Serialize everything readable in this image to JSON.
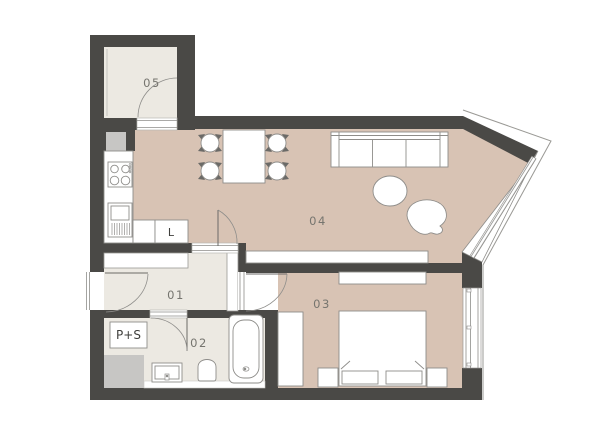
{
  "floorplan": {
    "rooms": {
      "r01": {
        "label": "01",
        "name": "hallway"
      },
      "r02": {
        "label": "02",
        "name": "bathroom"
      },
      "r03": {
        "label": "03",
        "name": "bedroom"
      },
      "r04": {
        "label": "04",
        "name": "living-room-kitchen"
      },
      "r05": {
        "label": "05",
        "name": "storage"
      }
    },
    "fixtures": {
      "fridge": {
        "label": "L"
      },
      "washer_dryer": {
        "label": "P+S"
      }
    },
    "colors": {
      "wall": "#4a4946",
      "floor_main": "#d8c3b4",
      "floor_light": "#ece9e2",
      "shaft": "#c7c6c4",
      "furniture_stroke": "#8e8d8a",
      "thin_line": "#9a9995"
    }
  }
}
